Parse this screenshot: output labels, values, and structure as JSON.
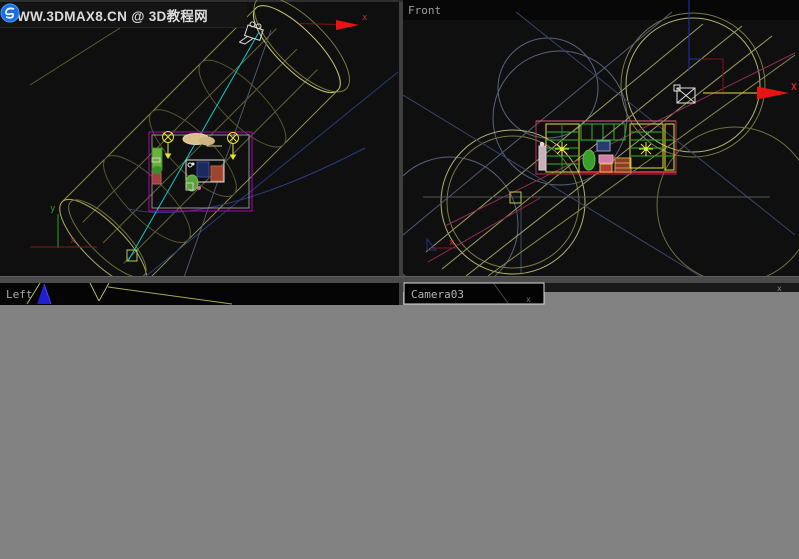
{
  "watermark": {
    "text": "WWW.3DMAX8.CN @ 3D教程网"
  },
  "viewports": {
    "front": {
      "label": "Front"
    },
    "left": {
      "label": "Left"
    },
    "camera": {
      "label": "Camera03"
    }
  },
  "axis": {
    "x": "x",
    "y": "y",
    "x_upper": "X"
  },
  "marks": {
    "camera_bar_mark": "x",
    "strip_mark": "x"
  },
  "colors": {
    "viewport_bg": "#0f0f0f",
    "wire_yellow": "#9c9c5e",
    "selection_cyan": "#00cfcf",
    "room_magenta": "#b300b3",
    "gizmo_red": "#e81414",
    "accent_blue": "#2020d0",
    "dead_region_gray": "#828282"
  }
}
